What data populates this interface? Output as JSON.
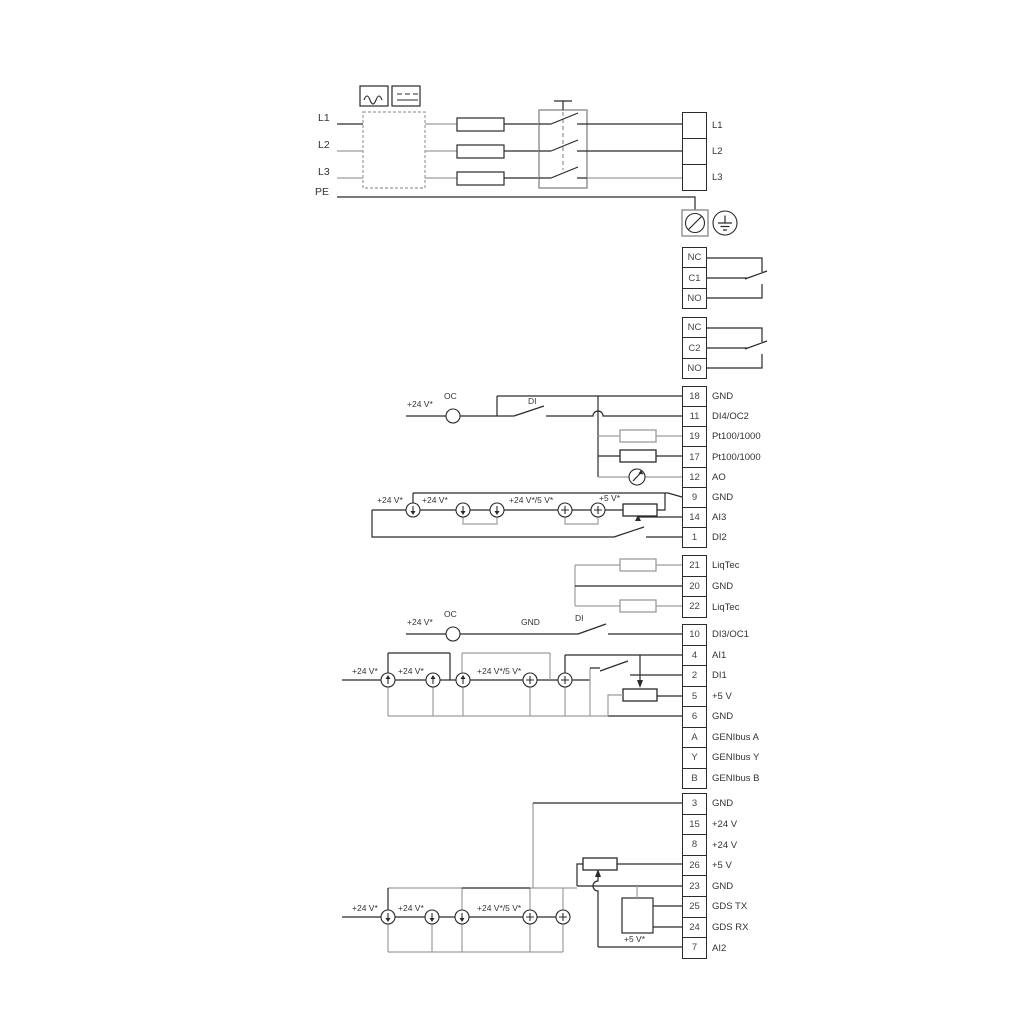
{
  "labels": {
    "l1": "L1",
    "l2": "L2",
    "l3": "L3",
    "pe": "PE",
    "v24": "+24 V*",
    "v24or5": "+24 V*/5 V*",
    "v5": "+5 V*",
    "oc": "OC",
    "di": "DI",
    "gnd": "GND"
  },
  "colors": {
    "wire_black": "#2a2a2a",
    "wire_gray": "#9c9c9c",
    "text": "#333333"
  },
  "icons": [
    "ac-symbol-icon",
    "dc-symbol-icon",
    "emc-filter-box",
    "fuse",
    "main-switch-icon",
    "screw-terminal-icon",
    "earth-ground-icon",
    "relay-contact-icon",
    "pt100-resistor",
    "analog-output-meter-icon",
    "current-source-icon",
    "voltage-source-icon",
    "open-collector-icon",
    "potentiometer",
    "gds-sensor-box",
    "di-switch-icon"
  ],
  "terminal_blocks": [
    {
      "id": "mains",
      "cells": [
        {
          "n": "",
          "label": "L1"
        },
        {
          "n": "",
          "label": "L2"
        },
        {
          "n": "",
          "label": "L3"
        }
      ]
    },
    {
      "id": "relay1",
      "cells": [
        {
          "n": "NC",
          "label": ""
        },
        {
          "n": "C1",
          "label": ""
        },
        {
          "n": "NO",
          "label": ""
        }
      ]
    },
    {
      "id": "relay2",
      "cells": [
        {
          "n": "NC",
          "label": ""
        },
        {
          "n": "C2",
          "label": ""
        },
        {
          "n": "NO",
          "label": ""
        }
      ]
    },
    {
      "id": "io1",
      "cells": [
        {
          "n": "18",
          "label": "GND"
        },
        {
          "n": "11",
          "label": "DI4/OC2"
        },
        {
          "n": "19",
          "label": "Pt100/1000"
        },
        {
          "n": "17",
          "label": "Pt100/1000"
        },
        {
          "n": "12",
          "label": "AO"
        },
        {
          "n": "9",
          "label": "GND"
        },
        {
          "n": "14",
          "label": "AI3"
        },
        {
          "n": "1",
          "label": "DI2"
        }
      ]
    },
    {
      "id": "liqtec",
      "cells": [
        {
          "n": "21",
          "label": "LiqTec"
        },
        {
          "n": "20",
          "label": "GND"
        },
        {
          "n": "22",
          "label": "LiqTec"
        }
      ]
    },
    {
      "id": "io2",
      "cells": [
        {
          "n": "10",
          "label": "DI3/OC1"
        },
        {
          "n": "4",
          "label": "AI1"
        },
        {
          "n": "2",
          "label": "DI1"
        },
        {
          "n": "5",
          "label": "+5 V"
        },
        {
          "n": "6",
          "label": "GND"
        },
        {
          "n": "A",
          "label": "GENIbus A"
        },
        {
          "n": "Y",
          "label": "GENIbus Y"
        },
        {
          "n": "B",
          "label": "GENIbus B"
        }
      ]
    },
    {
      "id": "io3",
      "cells": [
        {
          "n": "3",
          "label": "GND"
        },
        {
          "n": "15",
          "label": "+24 V"
        },
        {
          "n": "8",
          "label": "+24 V"
        },
        {
          "n": "26",
          "label": "+5 V"
        },
        {
          "n": "23",
          "label": "GND"
        },
        {
          "n": "25",
          "label": "GDS TX"
        },
        {
          "n": "24",
          "label": "GDS RX"
        },
        {
          "n": "7",
          "label": "AI2"
        }
      ]
    }
  ]
}
